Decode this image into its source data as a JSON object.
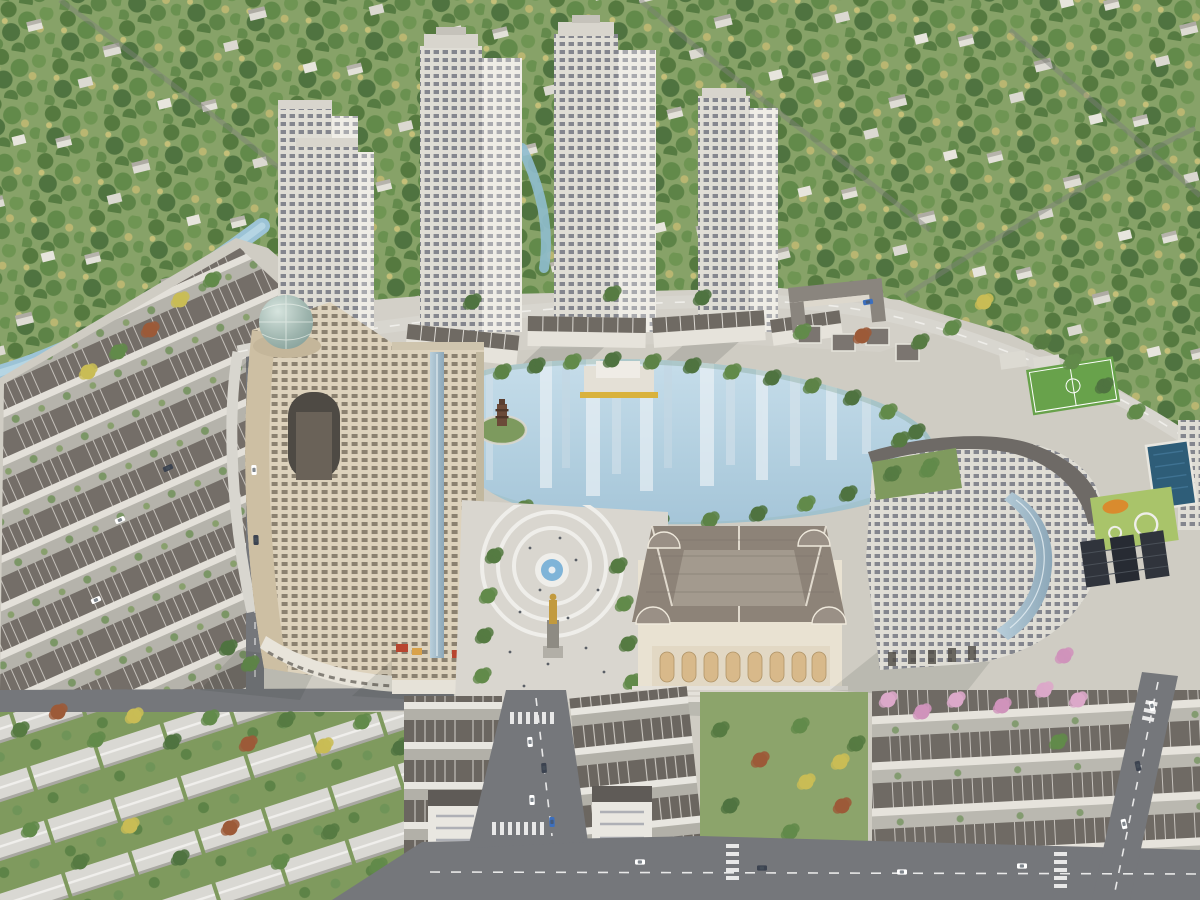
{
  "scene": {
    "title": "Aerial 3D masterplan rendering of a mixed-use residential complex with lake",
    "labels": {
      "forest": "Surrounding forest with scattered low-density villas",
      "canal": "Landscaped canal winding along the forest edge",
      "towers": "Cluster of white high-rise apartment towers on a podium",
      "viaduct": "Curved internal boulevard under the towers",
      "lakefront_blocks": "Curved row of low-rise lakefront apartment blocks",
      "school": "U-shaped school building and villas north of the lake",
      "lake": "Central landscaped lake with building reflections",
      "island": "Small island with stone pagoda tower",
      "stage": "Floating lakeside pavilion with yellow deck edge",
      "dome_tower": "Curved cream hotel tower topped with a glass dome",
      "apartment_tower": "Cream high-rise apartment tower with glass spine",
      "plaza": "Semicircular central pedestrian plaza",
      "fountain": "Round plaza fountain",
      "statue": "Golden monument statue on pedestal",
      "opera": "Classical opera-house style building with hipped roof and corner domes",
      "curved_building": "Curved mid-rise hotel block with roof garden and glass corner",
      "field": "Green football pitch with white markings",
      "pool": "Dark blue swimming pool",
      "amenity_deck": "Rooftop amenity lawn with playground",
      "townhouses_left": "Diagonal rows of shophouse townhouses, west district",
      "townhouses_bottom": "Shophouse rows flanking the south avenue",
      "townhouses_right": "Shophouse rows, south-east district",
      "garden": "Tree-filled neighbourhood garden",
      "sheds": "Rows of long white buildings among dense trees",
      "roads": "Internal road network with cars and crosswalks"
    }
  },
  "palette": {
    "forest_green": "#6d8f55",
    "grass_light": "#a9c46a",
    "lake_blue": "#b3d0e0",
    "canal_blue": "#9cc3d6",
    "facade_cream": "#e6e2d6",
    "facade_warm": "#ddd2bc",
    "roof_grey": "#6f6a64",
    "roof_taupe": "#8d8378",
    "road_grey": "#75777b",
    "plaza_light": "#d9d6cf",
    "statue_gold": "#c29a3e",
    "pool_blue": "#2e5d78",
    "pitch_green": "#68a24b",
    "flower_pink": "#dba8c9",
    "dome_teal": "#7e9a94"
  }
}
